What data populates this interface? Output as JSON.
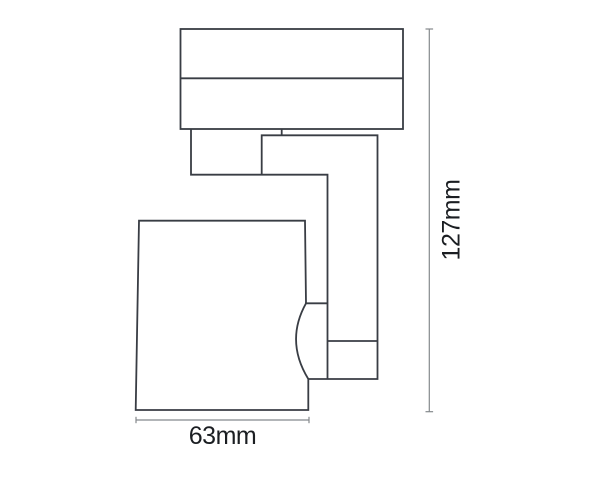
{
  "diagram": {
    "kind": "technical-dimension-drawing",
    "subject": "track-mounted spotlight, side elevation",
    "labels": {
      "width_dimension": "63mm",
      "height_dimension": "127mm"
    },
    "colors": {
      "background": "#ffffff",
      "outline": "#393d44",
      "dimension_line": "#85898d",
      "label_text": "#1b1e22"
    }
  }
}
